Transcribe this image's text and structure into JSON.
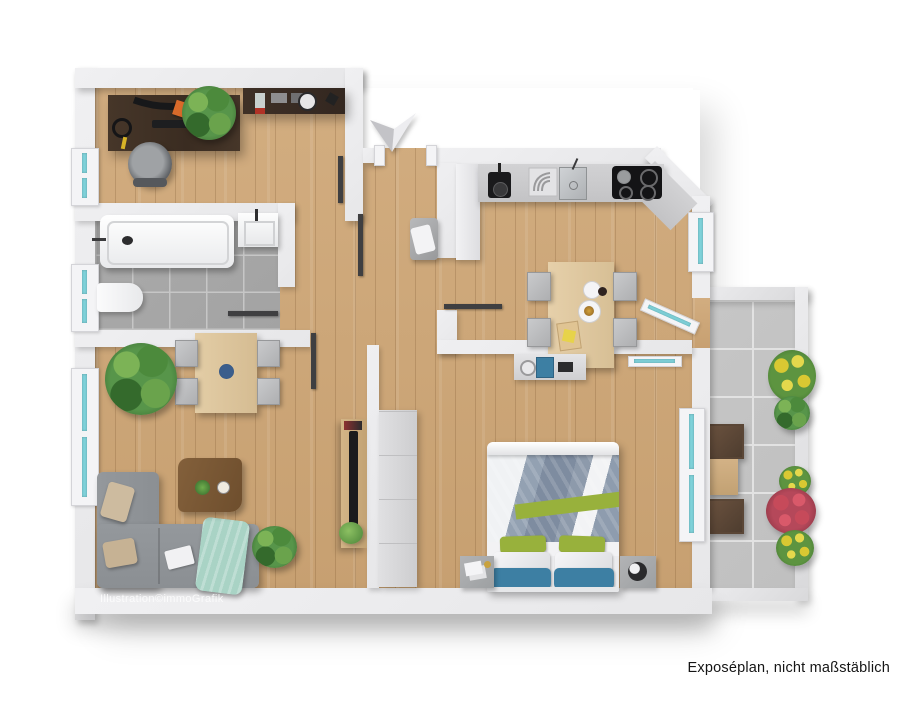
{
  "caption": "Exposéplan, nicht maßstäblich",
  "watermark": "Illustration©immoGrafik",
  "icons": {
    "entrance_arrow": "entrance-direction-arrow"
  },
  "colors": {
    "wall": "#e7e7e9",
    "wood": "#cda87a",
    "bath_tile": "#a3a3a3",
    "balcony_tile": "#c0c0c0",
    "sofa": "#8b8f93",
    "accent_green": "#98b13c",
    "accent_blue": "#3d7fa3",
    "mint": "#a9d3c5",
    "window_glass": "#7fd2da",
    "plant": "#3e7a33",
    "flower_yellow": "#d9c832",
    "flower_red": "#c64a5a"
  }
}
